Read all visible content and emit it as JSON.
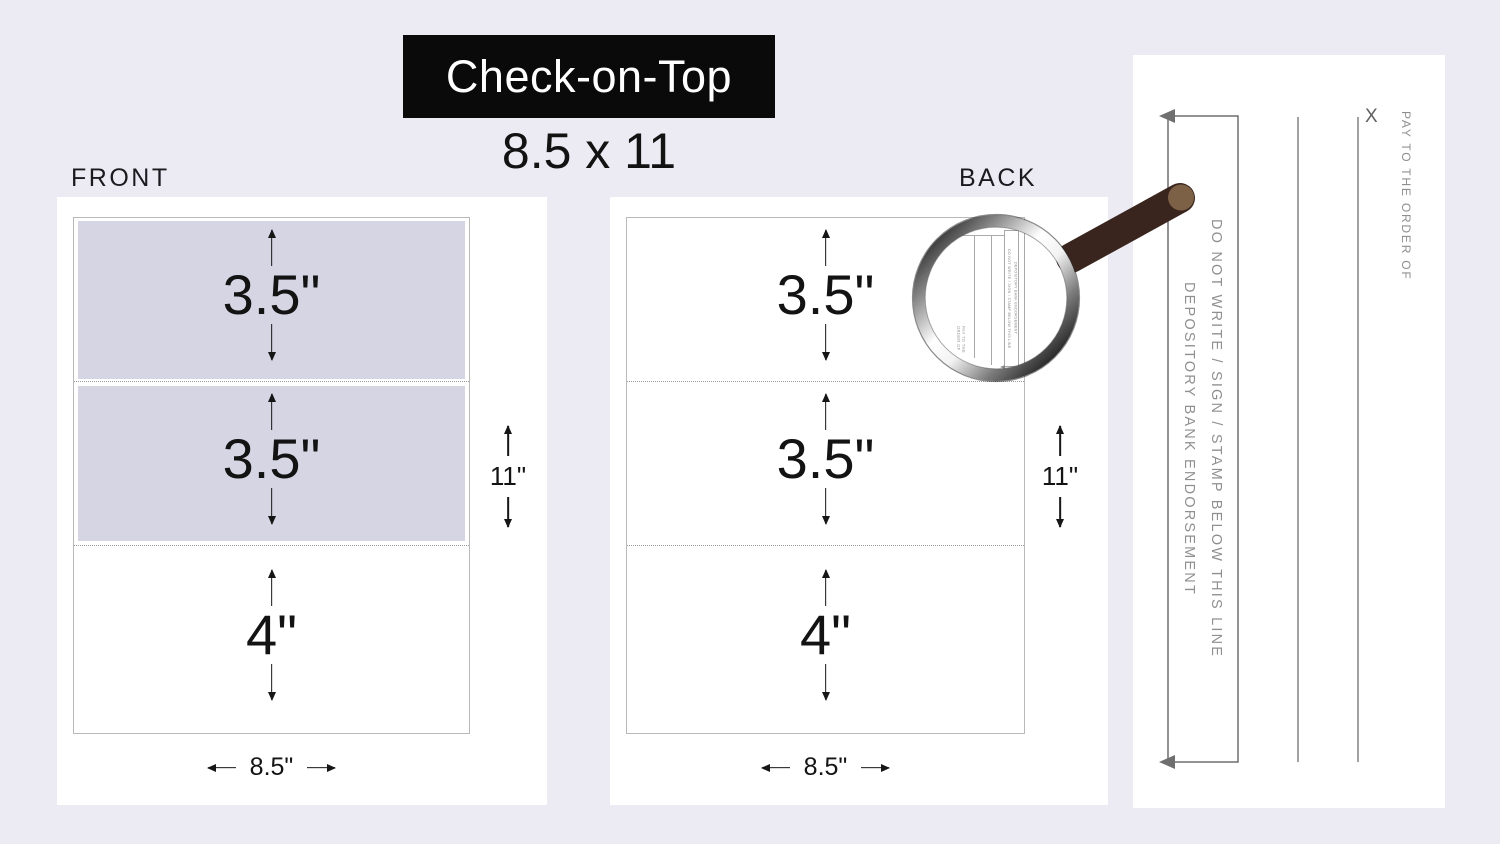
{
  "title": "Check-on-Top",
  "subtitle": "8.5 x 11",
  "front": {
    "label": "FRONT",
    "sections": [
      {
        "size": "3.5\""
      },
      {
        "size": "3.5\""
      },
      {
        "size": "4\""
      }
    ],
    "sheet_height": "11\"",
    "sheet_width": "8.5\""
  },
  "back": {
    "label": "BACK",
    "sections": [
      {
        "size": "3.5\""
      },
      {
        "size": "3.5\""
      },
      {
        "size": "4\""
      }
    ],
    "sheet_height": "11\"",
    "sheet_width": "8.5\""
  },
  "endorsement_panel": {
    "do_not_write_line": "DO NOT WRITE / SIGN / STAMP BELOW THIS LINE",
    "depository_line": "DEPOSITORY BANK ENDORSEMENT",
    "pay_to": "PAY TO THE ORDER OF",
    "x_mark": "X"
  },
  "magnifier_view": {
    "do_not_write_line": "DO NOT WRITE / SIGN / STAMP BELOW THIS LINE",
    "depository_line": "DEPOSITORY BANK ENDORSEMENT",
    "pay_to": "PAY TO THE ORDER OF",
    "x_mark": "x"
  },
  "colors": {
    "background": "#ECEBF3",
    "card": "#FFFFFF",
    "tint": "#D6D5E4",
    "title_bg": "#0A0A0A",
    "title_text": "#FFFFFF",
    "ink": "#161616",
    "gray_text": "#8F8F8F",
    "line_gray": "#6F6F6F",
    "border_gray": "#B9B9B9",
    "perf": "#9A9A9A",
    "handle_brown": "#3A251E",
    "handle_cap": "#7D6147"
  }
}
